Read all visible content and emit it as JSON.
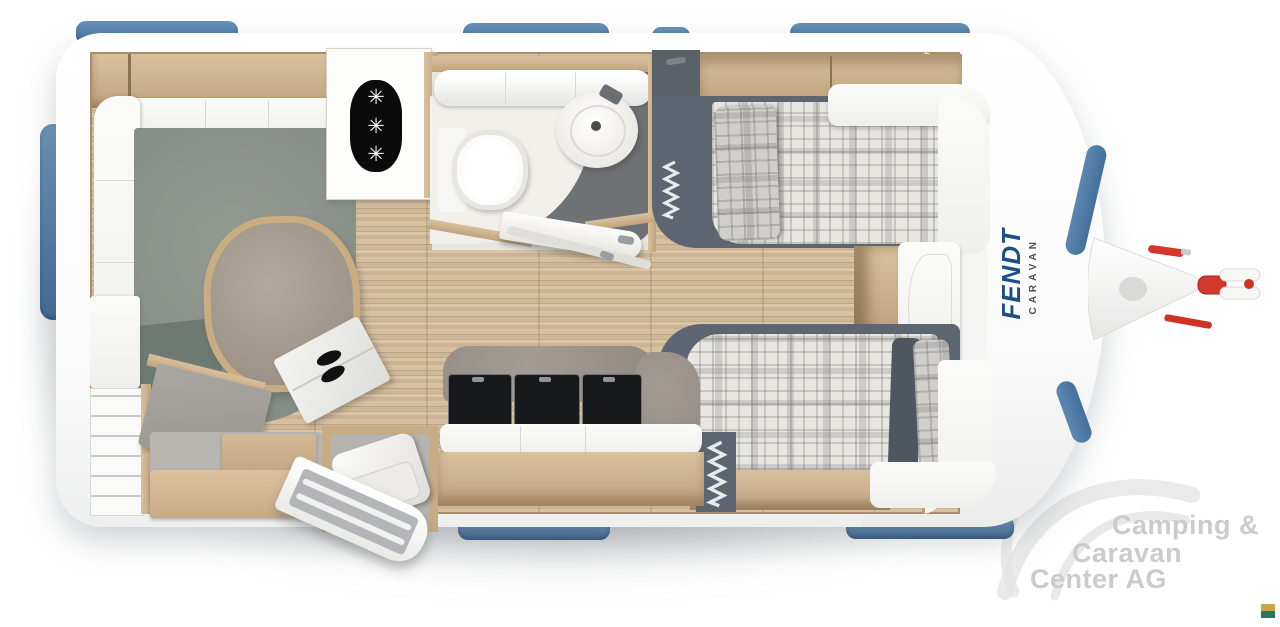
{
  "branding": {
    "name": "FENDT",
    "sub": "CARAVAN",
    "name_color": "#1b4f86",
    "sub_color": "#46525e"
  },
  "watermark": {
    "line1": "Camping &",
    "line2": "Caravan",
    "line3": "Center AG",
    "color": "#cbcbcb"
  },
  "icons": {
    "burner": "✳",
    "burner_count": 3,
    "zigzag": "concertina-symbol"
  },
  "colors": {
    "window_blue": "#5b84ab",
    "body_white": "#fdfdfd",
    "wood_floor": "#d0b996",
    "wood_furniture": "#cdb28d",
    "slate_bed_frame": "#5d6670",
    "lounge_carpet": "#8d938b",
    "bathroom_floor_dark": "#6f7274",
    "hitch_red": "#d2382c",
    "corner_mark_gold": "#c9a44e",
    "corner_mark_green": "#27775a"
  },
  "corner_mark": {
    "top_color": "#c9a44e",
    "bottom_color": "#27775a"
  }
}
